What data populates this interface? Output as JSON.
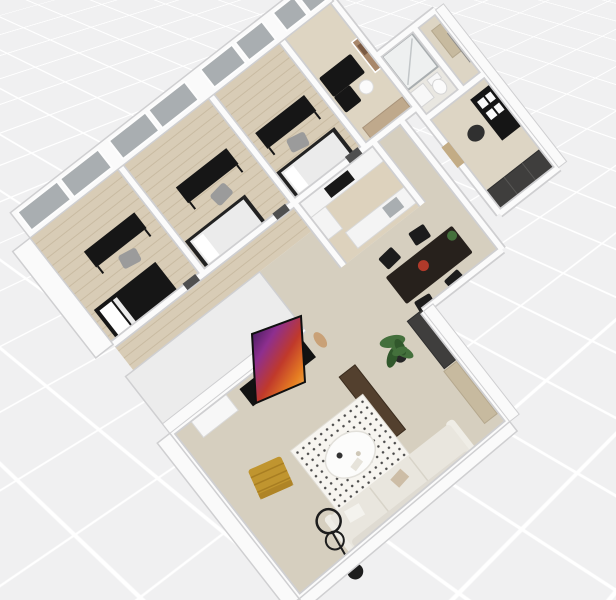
{
  "app": {
    "canvas_type": "3d-floorplan-dollhouse-view",
    "description": "Top-down oblique 3D render of an apartment floor plan on a white grid canvas"
  },
  "view": {
    "rotation_deg": -38,
    "background_grid": true,
    "grid_cell_px": 76
  },
  "palette": {
    "background": "#f0f0f1",
    "grid_line": "#ffffff",
    "wall_fill": "#fafafa",
    "wall_edge": "#cfcfd1",
    "wall_mass": "#ececec",
    "wood_floor": "#d8ccb6",
    "wood_plank_line": "#c9bba2",
    "lounge_floor": "#ded5c2",
    "kitchen_floor": "#ddd2bd",
    "beige_floor": "#d6cfbf",
    "bath_floor": "#e9e7e1",
    "entry_floor": "#ddd5c4",
    "window_glass": "#a9aeb1",
    "furniture_black": "#161616",
    "chair_gray": "#9b9b9b",
    "counter_white": "#f4f4f4",
    "table_brown": "#27211c",
    "accent_red": "#b03a2a",
    "bench_dark": "#53402e",
    "bench_light": "#c7ba9f",
    "sofa_cream": "#e9e6de",
    "sofa_back": "#dfdbd2",
    "sofa_arm": "#efede6",
    "rug_white": "#f7f5f0",
    "rug_dot": "#2b2b2b",
    "gold": "#c0952f",
    "gold_dark": "#a87e22",
    "plant_green": "#44703c",
    "plant_green_dark": "#31582c",
    "pot_dark": "#262626",
    "lamp_black": "#1d1d1d",
    "door_tan": "#c3ac85",
    "door_dark": "#4f4f4f",
    "art_tan": "#a8876a",
    "art_brown": "#7a5a42",
    "wardrobe_dark": "#3f3e3d",
    "sculpture_tan": "#c9a177",
    "white_soft": "#f7f7f7",
    "duvet_white": "#ebebeb",
    "pillow_white": "#ffffff",
    "tv_purple": "#2c1550",
    "tv_magenta": "#8e2f8f",
    "tv_red": "#c0392b",
    "tv_orange": "#e67e22",
    "tv_gold": "#f0c060"
  },
  "rooms": [
    {
      "name": "Bedroom 1",
      "floor": "wood",
      "items": [
        "double bed",
        "desk",
        "desk chair",
        "window"
      ]
    },
    {
      "name": "Bedroom 2",
      "floor": "wood",
      "items": [
        "bed",
        "desk",
        "desk chair",
        "window"
      ]
    },
    {
      "name": "Bedroom 3",
      "floor": "wood",
      "items": [
        "bed",
        "desk",
        "desk chair",
        "window"
      ]
    },
    {
      "name": "Lounge office",
      "floor": "laminate",
      "items": [
        "wall art",
        "black sectional sofa",
        "round side table",
        "sideboard",
        "window"
      ]
    },
    {
      "name": "Kitchen",
      "floor": "laminate",
      "items": [
        "counter with cooktop",
        "tall cabinet",
        "island with sink"
      ]
    },
    {
      "name": "Dining area",
      "floor": "screed",
      "items": [
        "dark dining table",
        "four black chairs",
        "red bowl",
        "plant"
      ]
    },
    {
      "name": "Bathroom",
      "floor": "tile",
      "items": [
        "walk-in shower",
        "toilet",
        "washbasin"
      ]
    },
    {
      "name": "Entry hall",
      "floor": "screed",
      "items": [
        "bench",
        "sliding glass door"
      ]
    },
    {
      "name": "Office nook",
      "floor": "screed",
      "items": [
        "black shelf unit",
        "office chair",
        "dark wardrobe"
      ]
    },
    {
      "name": "Living room",
      "floor": "screed",
      "items": [
        "wall TV",
        "black media console",
        "white cabinet",
        "decor figure",
        "potted plant",
        "dark wood bench",
        "dotted rug",
        "round coffee table",
        "cream sofa",
        "gold lounge chair",
        "arc floor lamp",
        "light wood bench",
        "dark wardrobe"
      ]
    }
  ]
}
